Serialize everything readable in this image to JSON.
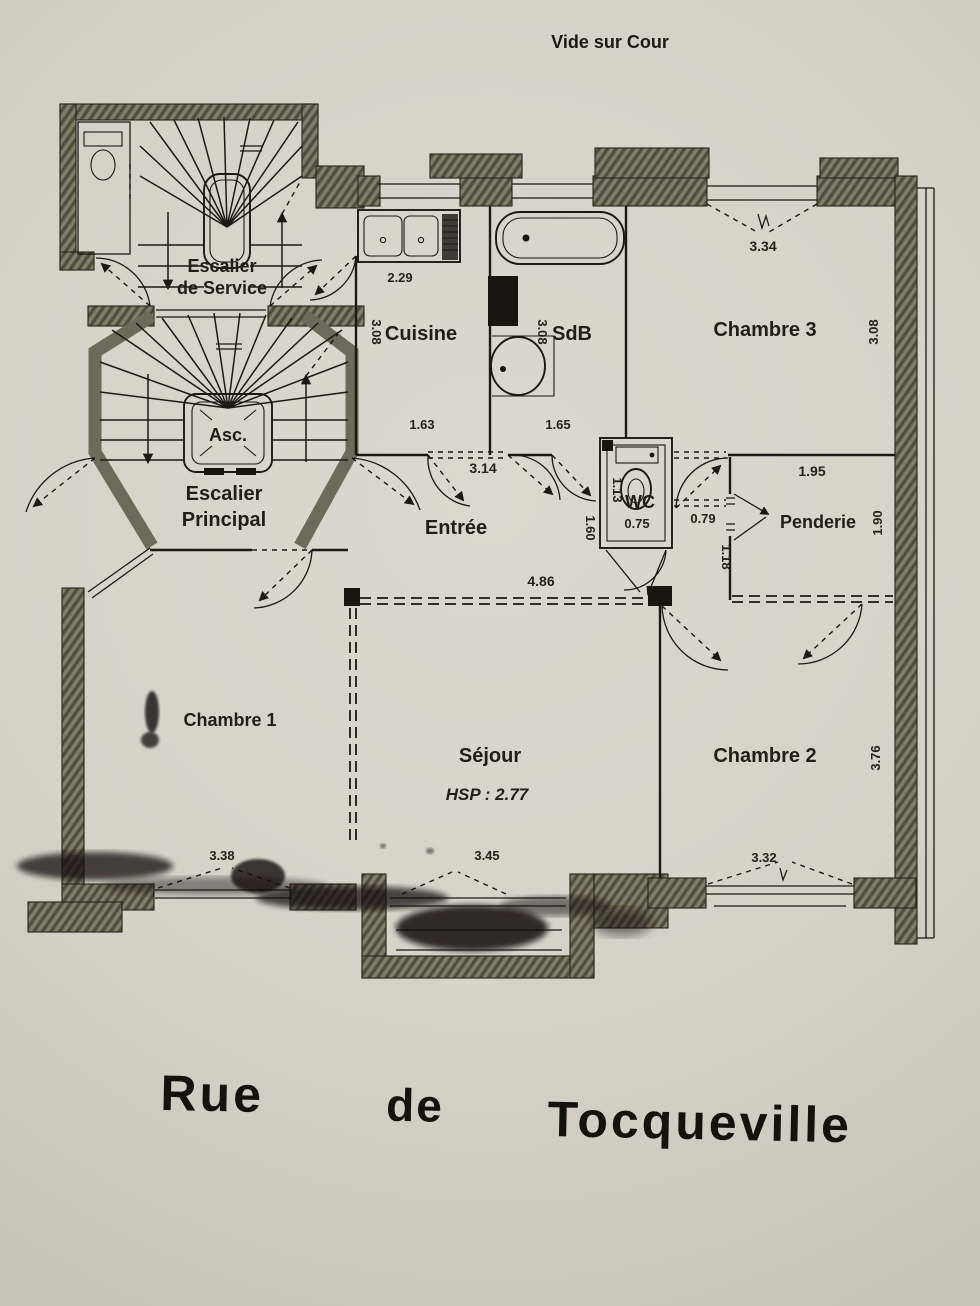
{
  "page": {
    "top_label": "Vide sur Cour",
    "street": {
      "w1": "Rue",
      "w2": "de",
      "w3": "Tocqueville"
    }
  },
  "rooms": {
    "escalier_service": {
      "name_line1": "Escalier",
      "name_line2": "de Service"
    },
    "escalier_principal": {
      "name_line1": "Escalier",
      "name_line2": "Principal"
    },
    "ascenseur": {
      "name": "Asc."
    },
    "cuisine": {
      "name": "Cuisine",
      "dim_counter": "2.29",
      "dim_depth": "3.08",
      "dim_width": "1.63"
    },
    "sdb": {
      "name": "SdB",
      "dim_depth": "3.08",
      "dim_width": "1.65"
    },
    "chambre3": {
      "name": "Chambre 3",
      "dim_window": "3.34",
      "dim_depth": "3.08"
    },
    "entree": {
      "name": "Entrée",
      "dim_door": "3.14",
      "dim_width": "4.86"
    },
    "wc": {
      "name": "WC",
      "dim_depth": "1.13",
      "dim_width": "0.75",
      "dim_left": "1.60",
      "dim_passage": "0.79",
      "dim_right": "1.18"
    },
    "penderie": {
      "name": "Penderie",
      "dim_width": "1.95",
      "dim_depth": "1.90"
    },
    "chambre1": {
      "name": "Chambre 1",
      "dim_window": "3.38"
    },
    "sejour": {
      "name": "Séjour",
      "ceiling_height": "HSP : 2.77",
      "dim_window": "3.45"
    },
    "chambre2": {
      "name": "Chambre 2",
      "dim_depth": "3.76",
      "dim_window": "3.32"
    }
  }
}
